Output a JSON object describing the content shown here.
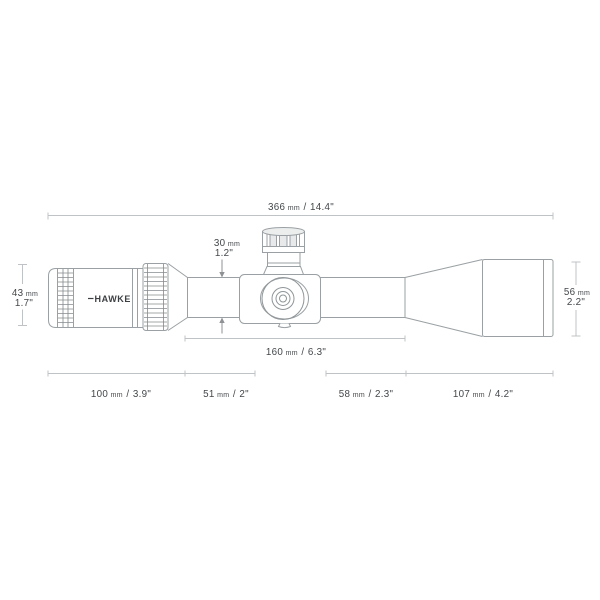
{
  "diagram": {
    "brand": "HAWKE",
    "sep": "/",
    "colors": {
      "outline": "#9aa0a3",
      "dimension_line": "#bfc3c5",
      "arrow": "#8e9295",
      "text": "#43474a",
      "background": "#ffffff"
    },
    "dims": {
      "overall": {
        "mm": "366",
        "unit": "mm",
        "in": "14.4\""
      },
      "tube": {
        "mm": "30",
        "unit": "mm",
        "in": "1.2\""
      },
      "eyepiece": {
        "mm": "43",
        "unit": "mm",
        "in": "1.7\""
      },
      "objective": {
        "mm": "56",
        "unit": "mm",
        "in": "2.2\""
      },
      "saddle": {
        "mm": "160",
        "unit": "mm",
        "in": "6.3\""
      },
      "seg1": {
        "mm": "100",
        "unit": "mm",
        "in": "3.9\""
      },
      "seg2": {
        "mm": "51",
        "unit": "mm",
        "in": "2\""
      },
      "seg3": {
        "mm": "58",
        "unit": "mm",
        "in": "2.3\""
      },
      "seg4": {
        "mm": "107",
        "unit": "mm",
        "in": "4.2\""
      }
    }
  }
}
